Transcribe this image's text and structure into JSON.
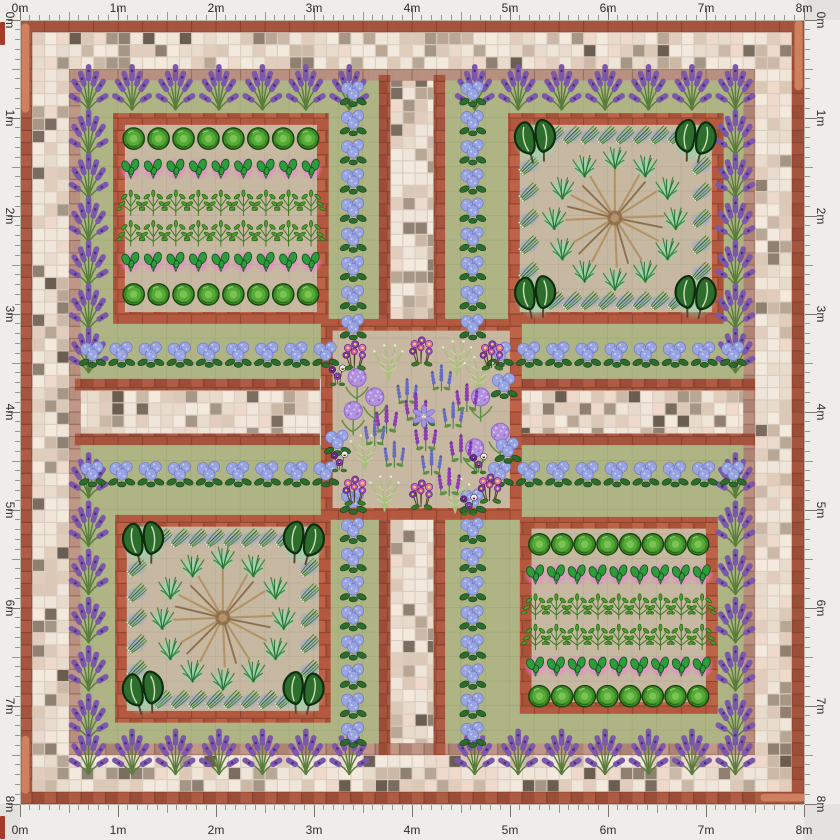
{
  "app": {
    "title": "Garden plan canvas",
    "canvas_size_label": "8m x 8m"
  },
  "rulers": {
    "unit_labels": [
      "0m",
      "1m",
      "2m",
      "3m",
      "4m",
      "5m",
      "6m",
      "7m",
      "8m"
    ],
    "meters": 8,
    "minor_ticks_per_meter": 10
  },
  "palette": {
    "page_bg": "#e4e2df",
    "ruler_bg": "#eeedea",
    "ruler_text": "#2f2d2a",
    "ruler_tick": "#9a948c",
    "ruler_tick_major": "#7a746c",
    "corner_marker": "#a53c2b",
    "mosaic_grout": "#d8cdc0",
    "mosaic_tiles": [
      "#efe5d8",
      "#f3eadd",
      "#e8dbcb",
      "#efd9ca",
      "#e2cdbd",
      "#dbc8b6",
      "#cbb8a6",
      "#b9a795",
      "#a69685",
      "#8f8071",
      "#7a6c5e",
      "#6b5d50"
    ],
    "mosaic_weights": [
      0.2,
      0.16,
      0.14,
      0.09,
      0.08,
      0.07,
      0.06,
      0.05,
      0.05,
      0.04,
      0.03,
      0.03
    ],
    "brick_grout": "#8a4331",
    "brick_tiles": [
      "#a5543e",
      "#b05c44",
      "#9c4d37",
      "#ad5840"
    ],
    "brick_bed_grout": "#93462f",
    "brick_bed_tiles": [
      "#b4593f",
      "#bd6348",
      "#aa5238",
      "#b85e44"
    ],
    "brick_muted_grout": "#997062",
    "brick_muted_tiles": [
      "#b98f80",
      "#c09686",
      "#ad8373",
      "#b28878"
    ],
    "lawn": "#aeb483",
    "lawn_line": "#98a36f",
    "soil": "#c6b8a1",
    "soil_line": "#ab9d85",
    "terracotta": "#d0805f",
    "terracotta_edge": "#a85a40",
    "glow_pink": "#f07fd6",
    "glow_mint": "#8fdcb4",
    "glow_periwinkle": "#9aa0dc"
  },
  "layout_m": {
    "px_per_m": 98,
    "tile": 0.125,
    "bed_border_w": 0.12,
    "brick_ring": [
      [
        0,
        0,
        8,
        0.125
      ],
      [
        0,
        7.875,
        8,
        0.125
      ],
      [
        0,
        0.125,
        0.125,
        7.75
      ],
      [
        7.875,
        0.125,
        0.125,
        7.75
      ]
    ],
    "mosaic_regions": [
      [
        0.125,
        0.125,
        7.75,
        0.375
      ],
      [
        0.125,
        7.5,
        7.75,
        0.375
      ],
      [
        0.125,
        0.5,
        0.375,
        7.0
      ],
      [
        7.5,
        0.5,
        0.375,
        7.0
      ],
      [
        3.78,
        0.56,
        0.44,
        2.5
      ],
      [
        3.78,
        5.08,
        0.44,
        2.42
      ],
      [
        0.56,
        3.78,
        2.5,
        0.44
      ],
      [
        5.08,
        3.78,
        2.42,
        0.44
      ]
    ],
    "muted_ring": [
      [
        0.5,
        0.5,
        7.0,
        0.12
      ],
      [
        0.5,
        7.38,
        7.0,
        0.12
      ],
      [
        0.5,
        0.62,
        0.12,
        6.76
      ],
      [
        7.38,
        0.62,
        0.12,
        6.76
      ]
    ],
    "path_brick": [
      [
        3.66,
        0.56,
        0.12,
        2.5
      ],
      [
        4.22,
        0.56,
        0.12,
        2.5
      ],
      [
        3.66,
        5.08,
        0.12,
        2.42
      ],
      [
        4.22,
        5.08,
        0.12,
        2.42
      ],
      [
        0.56,
        3.66,
        2.5,
        0.12
      ],
      [
        0.56,
        4.22,
        2.5,
        0.12
      ],
      [
        5.08,
        3.66,
        2.42,
        0.12
      ],
      [
        5.08,
        4.22,
        2.42,
        0.12
      ]
    ],
    "lawns": [
      {
        "name": "lawn-top-left",
        "r": [
          0.62,
          0.62,
          3.04,
          3.04
        ]
      },
      {
        "name": "lawn-top-right",
        "r": [
          4.34,
          0.62,
          3.04,
          3.04
        ]
      },
      {
        "name": "lawn-bottom-left",
        "r": [
          0.62,
          4.34,
          3.04,
          3.04
        ]
      },
      {
        "name": "lawn-bottom-right",
        "r": [
          4.34,
          4.34,
          3.04,
          3.04
        ]
      }
    ],
    "beds": [
      {
        "name": "bed-top-left",
        "r": [
          0.95,
          0.95,
          2.2,
          2.15
        ]
      },
      {
        "name": "bed-top-right",
        "r": [
          4.98,
          0.95,
          2.2,
          2.15
        ]
      },
      {
        "name": "bed-bottom-left",
        "r": [
          0.97,
          5.05,
          2.2,
          2.12
        ]
      },
      {
        "name": "bed-bottom-right",
        "r": [
          5.1,
          5.07,
          2.02,
          2.01
        ]
      },
      {
        "name": "bed-center",
        "r": [
          3.07,
          3.05,
          2.05,
          2.05
        ]
      }
    ],
    "terracotta_strips": [
      {
        "name": "edging-left-top",
        "r": [
          0.01,
          0.03,
          0.09,
          0.92
        ]
      },
      {
        "name": "edging-left-bottom",
        "r": [
          0.01,
          7.3,
          0.09,
          0.6
        ]
      },
      {
        "name": "edging-right-top",
        "r": [
          7.9,
          0.0,
          0.09,
          0.72
        ]
      },
      {
        "name": "edging-bottom-right",
        "r": [
          7.55,
          7.89,
          0.47,
          0.09
        ]
      }
    ]
  },
  "plant_types": {
    "lavender": {
      "label": "Lavender",
      "color": "#7b58ab",
      "size": 0.54
    },
    "hydrangea": {
      "label": "Hydrangea",
      "color": "#99a5e0",
      "size": 0.34
    },
    "cabbage": {
      "label": "Cabbage",
      "color": "#3c8c28",
      "size": 0.28
    },
    "spinach": {
      "label": "Spinach",
      "color": "#2f9b3c",
      "size": 0.28
    },
    "pepper": {
      "label": "Leafy vegetable",
      "color": "#4f9e2e",
      "size": 0.33
    },
    "kale": {
      "label": "Kale",
      "color": "#2e6e2c",
      "size": 0.56
    },
    "garlic": {
      "label": "Garlic",
      "color": "#3f8a33",
      "size": 0.27
    },
    "chive": {
      "label": "Chives",
      "color": "#3b8a42",
      "size": 0.31
    },
    "twigstar": {
      "label": "Cane wigwam",
      "color": "#b39366",
      "size": 1.15
    },
    "primula": {
      "label": "Primula",
      "color": "#d462c2",
      "size": 0.37
    },
    "pansy": {
      "label": "Pansy",
      "color": "#6a2d96",
      "size": 0.3
    },
    "allium": {
      "label": "Allium",
      "color": "#b292e0",
      "size": 0.42
    },
    "salvia": {
      "label": "Salvia",
      "color": "#656cc6",
      "size": 0.37,
      "symbol": "spike"
    },
    "agastache": {
      "label": "Agastache",
      "color": "#8d3bb4",
      "size": 0.4,
      "symbol": "spike"
    },
    "fern": {
      "label": "Feathery herb",
      "color": "#a9bf7c",
      "size": 0.44
    },
    "clematis": {
      "label": "Clematis",
      "color": "#a293e2",
      "size": 0.31
    }
  },
  "plantings": [
    {
      "area": "lawn-top-left",
      "type": "lavender",
      "row": {
        "x0": 0.7,
        "y0": 0.68,
        "x1": 3.36,
        "y1": 0.68,
        "n": 7
      }
    },
    {
      "area": "lawn-top-left",
      "type": "lavender",
      "row": {
        "x0": 0.7,
        "y0": 1.14,
        "x1": 0.7,
        "y1": 3.36,
        "n": 6
      }
    },
    {
      "area": "lawn-top-right",
      "type": "lavender",
      "row": {
        "x0": 4.64,
        "y0": 0.68,
        "x1": 7.3,
        "y1": 0.68,
        "n": 7
      }
    },
    {
      "area": "lawn-top-right",
      "type": "lavender",
      "row": {
        "x0": 7.3,
        "y0": 1.14,
        "x1": 7.3,
        "y1": 3.36,
        "n": 6
      }
    },
    {
      "area": "lawn-bottom-left",
      "type": "lavender",
      "row": {
        "x0": 0.7,
        "y0": 4.64,
        "x1": 0.7,
        "y1": 7.1,
        "n": 6
      }
    },
    {
      "area": "lawn-bottom-left",
      "type": "lavender",
      "row": {
        "x0": 0.7,
        "y0": 7.46,
        "x1": 3.36,
        "y1": 7.46,
        "n": 7
      }
    },
    {
      "area": "lawn-bottom-right",
      "type": "lavender",
      "row": {
        "x0": 7.3,
        "y0": 4.64,
        "x1": 7.3,
        "y1": 7.1,
        "n": 6
      }
    },
    {
      "area": "lawn-bottom-right",
      "type": "lavender",
      "row": {
        "x0": 4.64,
        "y0": 7.46,
        "x1": 7.3,
        "y1": 7.46,
        "n": 7
      }
    },
    {
      "area": "lawn-top-left",
      "type": "hydrangea",
      "row": {
        "x0": 3.4,
        "y0": 0.74,
        "x1": 3.4,
        "y1": 3.12,
        "n": 9
      }
    },
    {
      "area": "lawn-top-left",
      "type": "hydrangea",
      "row": {
        "x0": 0.74,
        "y0": 3.4,
        "x1": 3.12,
        "y1": 3.4,
        "n": 9
      }
    },
    {
      "area": "lawn-top-right",
      "type": "hydrangea",
      "row": {
        "x0": 4.62,
        "y0": 0.74,
        "x1": 4.62,
        "y1": 3.12,
        "n": 9
      }
    },
    {
      "area": "lawn-top-right",
      "type": "hydrangea",
      "row": {
        "x0": 4.9,
        "y0": 3.4,
        "x1": 7.28,
        "y1": 3.4,
        "n": 9
      }
    },
    {
      "area": "lawn-bottom-left",
      "type": "hydrangea",
      "row": {
        "x0": 3.4,
        "y0": 4.9,
        "x1": 3.4,
        "y1": 7.28,
        "n": 9
      }
    },
    {
      "area": "lawn-bottom-left",
      "type": "hydrangea",
      "row": {
        "x0": 0.74,
        "y0": 4.62,
        "x1": 3.12,
        "y1": 4.62,
        "n": 9
      }
    },
    {
      "area": "lawn-bottom-right",
      "type": "hydrangea",
      "row": {
        "x0": 4.62,
        "y0": 4.9,
        "x1": 4.62,
        "y1": 7.28,
        "n": 9
      }
    },
    {
      "area": "lawn-bottom-right",
      "type": "hydrangea",
      "row": {
        "x0": 4.9,
        "y0": 4.62,
        "x1": 7.28,
        "y1": 4.62,
        "n": 9
      }
    },
    {
      "area": "bed-top-left",
      "type": "cabbage",
      "row": {
        "x0": 1.16,
        "y0": 1.21,
        "x1": 2.94,
        "y1": 1.21,
        "n": 8
      }
    },
    {
      "area": "bed-top-left",
      "type": "spinach",
      "row": {
        "x0": 1.13,
        "y0": 1.52,
        "x1": 2.97,
        "y1": 1.52,
        "n": 9
      }
    },
    {
      "area": "bed-top-left",
      "type": "pepper",
      "row": {
        "x0": 1.13,
        "y0": 1.86,
        "x1": 2.97,
        "y1": 1.86,
        "n": 9
      }
    },
    {
      "area": "bed-top-left",
      "type": "pepper",
      "row": {
        "x0": 1.13,
        "y0": 2.17,
        "x1": 2.97,
        "y1": 2.17,
        "n": 9
      }
    },
    {
      "area": "bed-top-left",
      "type": "spinach",
      "row": {
        "x0": 1.13,
        "y0": 2.47,
        "x1": 2.97,
        "y1": 2.47,
        "n": 9
      }
    },
    {
      "area": "bed-top-left",
      "type": "cabbage",
      "row": {
        "x0": 1.16,
        "y0": 2.8,
        "x1": 2.94,
        "y1": 2.8,
        "n": 8
      }
    },
    {
      "area": "bed-bottom-right",
      "type": "cabbage",
      "row": {
        "x0": 5.3,
        "y0": 5.35,
        "x1": 6.92,
        "y1": 5.35,
        "n": 8
      }
    },
    {
      "area": "bed-bottom-right",
      "type": "spinach",
      "row": {
        "x0": 5.26,
        "y0": 5.66,
        "x1": 6.96,
        "y1": 5.66,
        "n": 9
      }
    },
    {
      "area": "bed-bottom-right",
      "type": "pepper",
      "row": {
        "x0": 5.26,
        "y0": 5.98,
        "x1": 6.96,
        "y1": 5.98,
        "n": 9
      }
    },
    {
      "area": "bed-bottom-right",
      "type": "pepper",
      "row": {
        "x0": 5.26,
        "y0": 6.29,
        "x1": 6.96,
        "y1": 6.29,
        "n": 9
      }
    },
    {
      "area": "bed-bottom-right",
      "type": "spinach",
      "row": {
        "x0": 5.26,
        "y0": 6.6,
        "x1": 6.96,
        "y1": 6.6,
        "n": 9
      }
    },
    {
      "area": "bed-bottom-right",
      "type": "cabbage",
      "row": {
        "x0": 5.3,
        "y0": 6.9,
        "x1": 6.92,
        "y1": 6.9,
        "n": 8
      }
    },
    {
      "area": "bed-top-right",
      "type": "twigstar",
      "at": [
        6.07,
        2.02
      ]
    },
    {
      "area": "bed-top-right",
      "type": "garlic",
      "row": {
        "x0": 5.45,
        "y0": 1.17,
        "x1": 6.7,
        "y1": 1.17,
        "n": 8
      }
    },
    {
      "area": "bed-top-right",
      "type": "garlic",
      "row": {
        "x0": 5.45,
        "y0": 2.86,
        "x1": 6.7,
        "y1": 2.86,
        "n": 8
      }
    },
    {
      "area": "bed-top-right",
      "type": "garlic",
      "row": {
        "x0": 5.19,
        "y0": 1.48,
        "x1": 5.19,
        "y1": 2.56,
        "n": 5
      }
    },
    {
      "area": "bed-top-right",
      "type": "garlic",
      "row": {
        "x0": 6.95,
        "y0": 1.48,
        "x1": 6.95,
        "y1": 2.56,
        "n": 5
      }
    },
    {
      "area": "bed-top-right",
      "type": "chive",
      "circle": {
        "cx": 6.07,
        "cy": 2.02,
        "r": 0.62,
        "n": 12
      }
    },
    {
      "area": "bed-top-right",
      "type": "kale",
      "pts": [
        [
          5.26,
          1.23
        ],
        [
          6.89,
          1.23
        ],
        [
          5.26,
          2.82
        ],
        [
          6.89,
          2.82
        ]
      ],
      "rots": [
        -8,
        8,
        -5,
        6
      ]
    },
    {
      "area": "bed-bottom-left",
      "type": "twigstar",
      "at": [
        2.07,
        6.1
      ]
    },
    {
      "area": "bed-bottom-left",
      "type": "garlic",
      "row": {
        "x0": 1.45,
        "y0": 5.28,
        "x1": 2.7,
        "y1": 5.28,
        "n": 8
      }
    },
    {
      "area": "bed-bottom-left",
      "type": "garlic",
      "row": {
        "x0": 1.45,
        "y0": 6.93,
        "x1": 2.7,
        "y1": 6.93,
        "n": 8
      }
    },
    {
      "area": "bed-bottom-left",
      "type": "garlic",
      "row": {
        "x0": 1.19,
        "y0": 5.58,
        "x1": 1.19,
        "y1": 6.62,
        "n": 5
      }
    },
    {
      "area": "bed-bottom-left",
      "type": "garlic",
      "row": {
        "x0": 2.95,
        "y0": 5.58,
        "x1": 2.95,
        "y1": 6.62,
        "n": 5
      }
    },
    {
      "area": "bed-bottom-left",
      "type": "chive",
      "circle": {
        "cx": 2.07,
        "cy": 6.1,
        "r": 0.62,
        "n": 12
      }
    },
    {
      "area": "bed-bottom-left",
      "type": "kale",
      "pts": [
        [
          1.26,
          5.33
        ],
        [
          2.89,
          5.33
        ],
        [
          1.26,
          6.86
        ],
        [
          2.89,
          6.86
        ]
      ],
      "rots": [
        -6,
        9,
        -9,
        5
      ]
    },
    {
      "area": "bed-center",
      "type": "fern",
      "pts": [
        [
          3.76,
          3.48
        ],
        [
          4.46,
          3.44
        ],
        [
          3.72,
          4.82
        ],
        [
          4.44,
          4.84
        ],
        [
          3.52,
          4.4
        ],
        [
          4.68,
          3.6
        ]
      ]
    },
    {
      "area": "bed-center",
      "type": "allium",
      "pts": [
        [
          3.44,
          3.72
        ],
        [
          3.4,
          4.06
        ],
        [
          3.62,
          3.92
        ],
        [
          4.7,
          3.92
        ],
        [
          4.9,
          4.28
        ],
        [
          4.64,
          4.44
        ]
      ]
    },
    {
      "area": "bed-center",
      "type": "hydrangea",
      "pts": [
        [
          4.94,
          3.72
        ],
        [
          4.98,
          4.38
        ],
        [
          3.24,
          4.3
        ]
      ]
    },
    {
      "area": "bed-center",
      "type": "salvia",
      "pts": [
        [
          4.3,
          3.64
        ],
        [
          3.95,
          3.78
        ],
        [
          4.42,
          4.02
        ],
        [
          3.82,
          4.42
        ],
        [
          4.2,
          4.5
        ],
        [
          3.62,
          4.2
        ]
      ]
    },
    {
      "area": "bed-center",
      "type": "agastache",
      "pts": [
        [
          4.04,
          3.94
        ],
        [
          4.14,
          4.24
        ],
        [
          3.74,
          4.06
        ],
        [
          4.5,
          4.36
        ],
        [
          4.38,
          4.7
        ],
        [
          4.56,
          3.84
        ]
      ]
    },
    {
      "area": "bed-center",
      "type": "pansy",
      "pts": [
        [
          3.24,
          3.62
        ],
        [
          3.26,
          4.5
        ],
        [
          4.68,
          4.52
        ],
        [
          4.58,
          4.94
        ]
      ]
    },
    {
      "area": "bed-center",
      "type": "primula",
      "pts": [
        [
          3.42,
          3.42
        ],
        [
          4.1,
          3.38
        ],
        [
          4.82,
          3.42
        ],
        [
          3.42,
          4.8
        ],
        [
          4.1,
          4.84
        ],
        [
          4.8,
          4.78
        ]
      ]
    },
    {
      "area": "bed-center",
      "type": "clematis",
      "at": [
        4.12,
        4.06
      ]
    }
  ]
}
